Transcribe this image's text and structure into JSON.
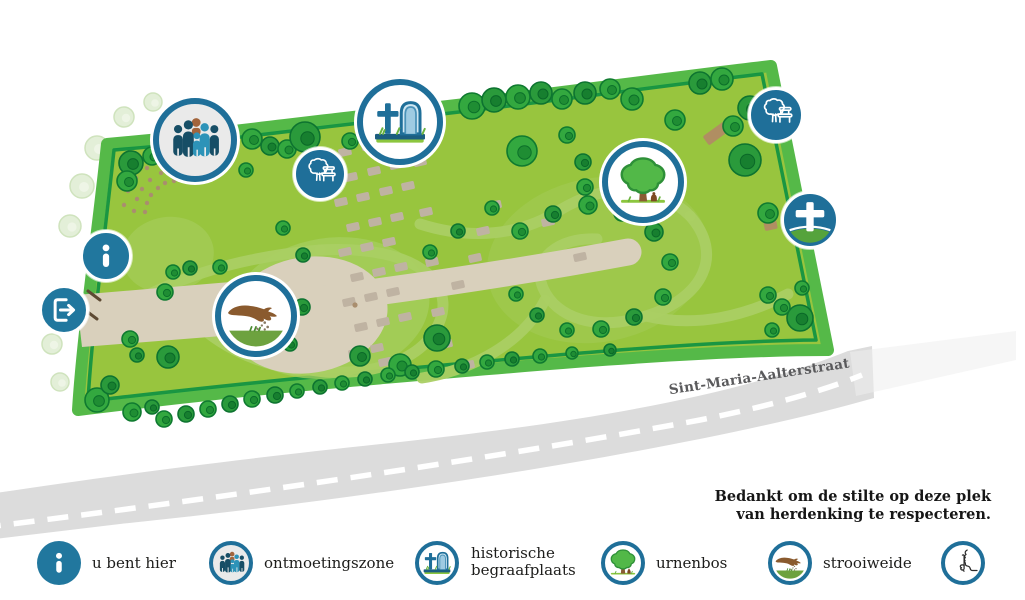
{
  "road": {
    "label": "Sint-Maria-Aalterstraat"
  },
  "notice": {
    "line1": "Bedankt om de stilte op deze plek",
    "line2": "van herdenking te respecteren."
  },
  "legend": {
    "items": [
      {
        "id": "u-bent-hier",
        "icon": "info-icon",
        "label": "u bent hier"
      },
      {
        "id": "ontmoetingszone",
        "icon": "people-icon",
        "label": "ontmoetingszone"
      },
      {
        "id": "historische-begraafplaats",
        "icon": "gravestone-cross-icon",
        "label": "historische begraafplaats"
      },
      {
        "id": "urnenbos",
        "icon": "tree-urn-icon",
        "label": "urnenbos"
      },
      {
        "id": "strooiweide",
        "icon": "scattering-hand-icon",
        "label": "strooiweide"
      },
      {
        "id": "stilte",
        "icon": "silence-icon",
        "label": ""
      }
    ]
  },
  "map_markers": [
    {
      "id": "u-bent-hier",
      "icon": "info-icon"
    },
    {
      "id": "uitgang",
      "icon": "exit-icon"
    },
    {
      "id": "ontmoetingszone",
      "icon": "people-icon"
    },
    {
      "id": "strooiweide",
      "icon": "scattering-hand-icon"
    },
    {
      "id": "rustpunt-west",
      "icon": "tree-bench-icon"
    },
    {
      "id": "historische-begraafplaats",
      "icon": "gravestone-cross-icon"
    },
    {
      "id": "urnenbos",
      "icon": "tree-urn-icon"
    },
    {
      "id": "rustpunt-oost",
      "icon": "tree-bench-icon"
    },
    {
      "id": "kruis",
      "icon": "cross-icon"
    }
  ],
  "colors": {
    "accent_blue": "#1f6f99",
    "teal": "#21779e",
    "park_green": "#98c53e",
    "border_green": "#55b948",
    "border_dark_line": "#0c9043",
    "road_gray": "#dcdcdc",
    "path_beige": "#d9d0bc"
  }
}
